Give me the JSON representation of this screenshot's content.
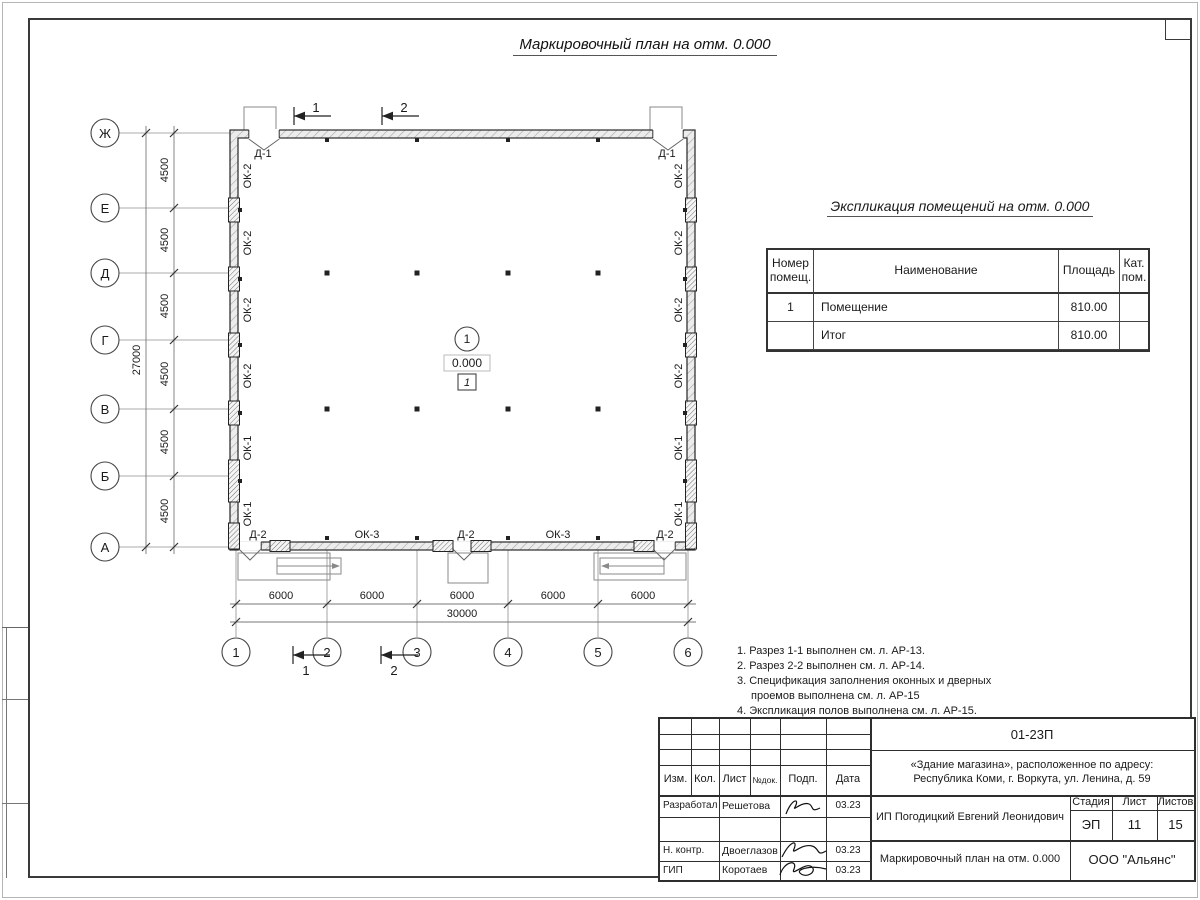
{
  "colors": {
    "line": "#3a3a3a",
    "hatch": "#9a9a9a"
  },
  "title": "Маркировочный план на отм. 0.000",
  "plan": {
    "row_axes": [
      "Ж",
      "Е",
      "Д",
      "Г",
      "В",
      "Б",
      "А"
    ],
    "col_axes": [
      "1",
      "2",
      "3",
      "4",
      "5",
      "6"
    ],
    "dims": {
      "row_step": "4500",
      "row_total": "27000",
      "col_step": "6000",
      "col_total": "30000"
    },
    "openings": {
      "door1": "Д-1",
      "door2": "Д-2",
      "win1": "ОК-1",
      "win2": "ОК-2",
      "win3": "ОК-3"
    },
    "sections": {
      "s1": "1",
      "s2": "2"
    },
    "room": {
      "number": "1",
      "elevation": "0.000",
      "floor_type": "1"
    }
  },
  "explication": {
    "title": "Экспликация помещений на отм. 0.000",
    "columns": {
      "num": "Номер помещ.",
      "name": "Наименование",
      "area": "Площадь",
      "cat": "Кат. пом."
    },
    "rows": [
      {
        "num": "1",
        "name": "Помещение",
        "area": "810.00",
        "cat": ""
      },
      {
        "num": "",
        "name": "Итог",
        "area": "810.00",
        "cat": ""
      }
    ]
  },
  "notes": {
    "items": [
      "1. Разрез 1-1 выполнен см. л. АР-13.",
      "2. Разрез 2-2 выполнен см. л. АР-14.",
      "3. Спецификация заполнения оконных и дверных проемов выполнена см. л. АР-15",
      "4. Экспликация полов выполнена см. л. АР-15."
    ]
  },
  "titleblock": {
    "code": "01-23П",
    "address1": "«Здание магазина», расположенное по адресу:",
    "address2": "Республика Коми, г. Воркута, ул. Ленина, д. 59",
    "header": [
      "Изм.",
      "Кол.",
      "Лист",
      "№док.",
      "Подп.",
      "Дата"
    ],
    "rows": [
      {
        "role": "Разработал",
        "name": "Решетова",
        "date": "03.23"
      },
      {
        "role": "Н. контр.",
        "name": "Двоеглазов",
        "date": "03.23"
      },
      {
        "role": "ГИП",
        "name": "Коротаев",
        "date": "03.23"
      }
    ],
    "client": "ИП Погодицкий Евгений Леонидович",
    "stage_label": "Стадия",
    "sheet_label": "Лист",
    "sheets_label": "Листов",
    "stage": "ЭП",
    "sheet": "11",
    "sheets": "15",
    "doc_name": "Маркировочный план на отм. 0.000",
    "company": "ООО \"Альянс\""
  }
}
